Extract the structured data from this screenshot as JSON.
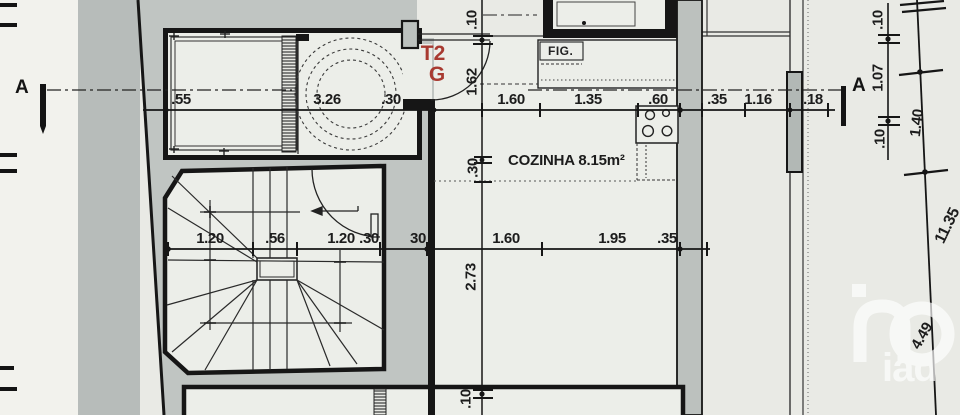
{
  "drawing": {
    "unit_label": {
      "line1": "T2",
      "line2": "G"
    },
    "rooms": {
      "kitchen_label": "COZINHA 8.15m²",
      "fridge_label": "FIG."
    },
    "section_marker": "A",
    "watermark_text": "iad",
    "colors": {
      "paper": "#e9eae5",
      "poche_gray": "#c0c5c2",
      "line_black": "#1c1c1c",
      "unit_red": "#a83a31"
    },
    "dims": {
      "top_row": [
        ".55",
        "3.26",
        ".30",
        "1.60",
        "1.35",
        ".60",
        ".35",
        "1.16",
        ".18"
      ],
      "mid_row": [
        "1.20",
        ".56",
        "1.20",
        ".30",
        "30",
        "1.60",
        "1.95",
        ".35"
      ],
      "center_vertical": [
        ".10",
        "1.62",
        ".30",
        "2.73",
        ".10"
      ],
      "right_vertical_inner": [
        ".10",
        "1.07",
        ".10"
      ],
      "right_vertical_outer": [
        "1.40",
        "11.35",
        "4.49"
      ]
    }
  }
}
